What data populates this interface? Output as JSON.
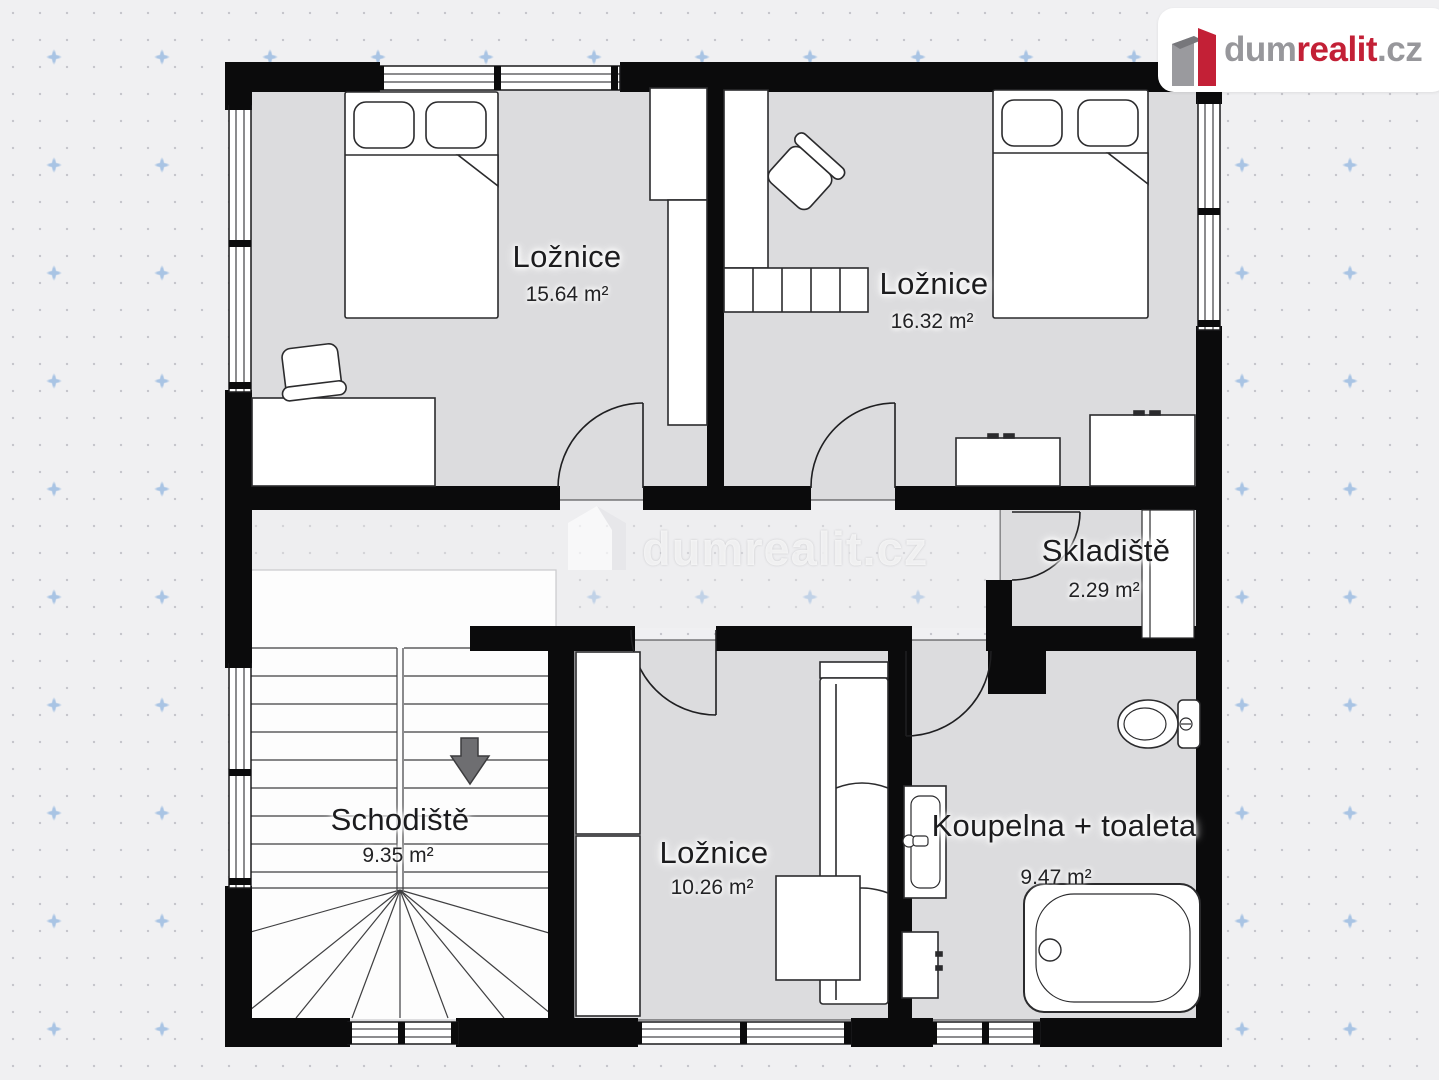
{
  "logo": {
    "text_gray": "dum",
    "text_accent": "realit",
    "text_suffix": ".cz",
    "accent_color": "#c32036",
    "gray_color": "#97979b"
  },
  "watermark": {
    "text": "dumrealit.cz"
  },
  "floorplan": {
    "rooms": [
      {
        "id": "bedroom-1",
        "name": "Ložnice",
        "area": "15.64 m²"
      },
      {
        "id": "bedroom-2",
        "name": "Ložnice",
        "area": "16.32 m²"
      },
      {
        "id": "storage",
        "name": "Skladiště",
        "area": "2.29 m²"
      },
      {
        "id": "staircase",
        "name": "Schodiště",
        "area": "9.35 m²"
      },
      {
        "id": "bedroom-3",
        "name": "Ložnice",
        "area": "10.26 m²"
      },
      {
        "id": "bathroom",
        "name": "Koupelna + toaleta",
        "area": "9.47 m²"
      }
    ]
  }
}
